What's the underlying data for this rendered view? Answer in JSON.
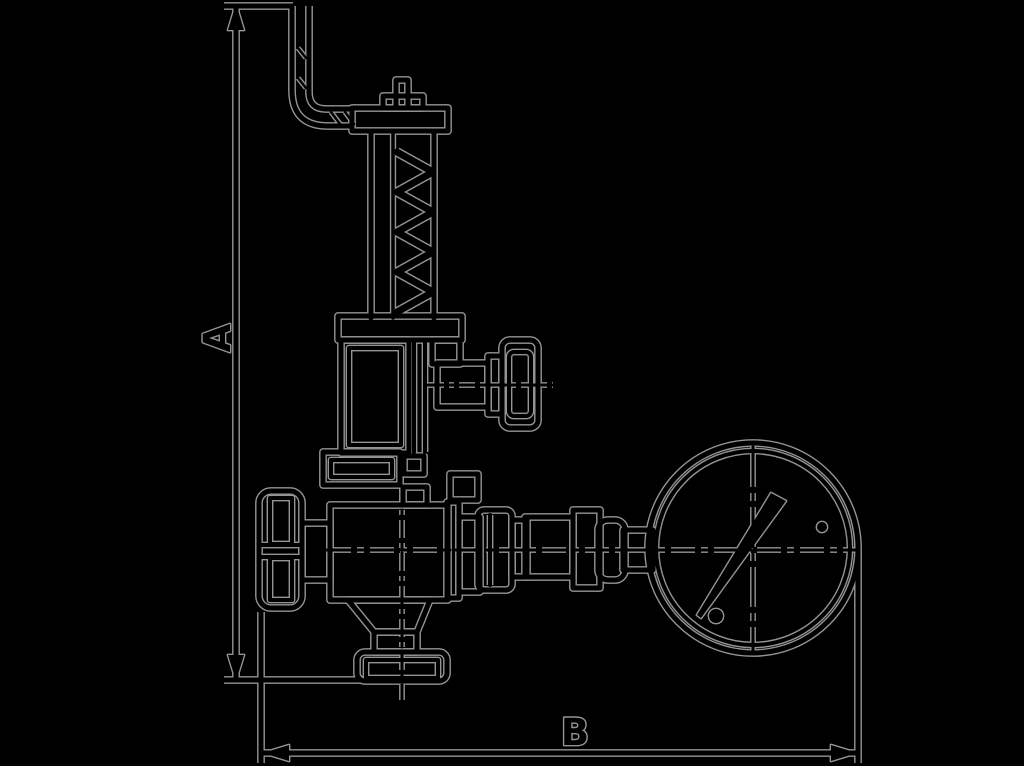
{
  "diagram": {
    "description": "Dimensioned technical line drawing of a spring-loaded safety relief valve with discharge bracket pipe, side test knob, left handwheel, bottom outlet flange and attached pressure gauge",
    "dimensions": {
      "vertical_label": "A",
      "horizontal_label": "B"
    }
  },
  "colors": {
    "background": "#000000",
    "ink": "#000000",
    "edge": "#949494"
  }
}
